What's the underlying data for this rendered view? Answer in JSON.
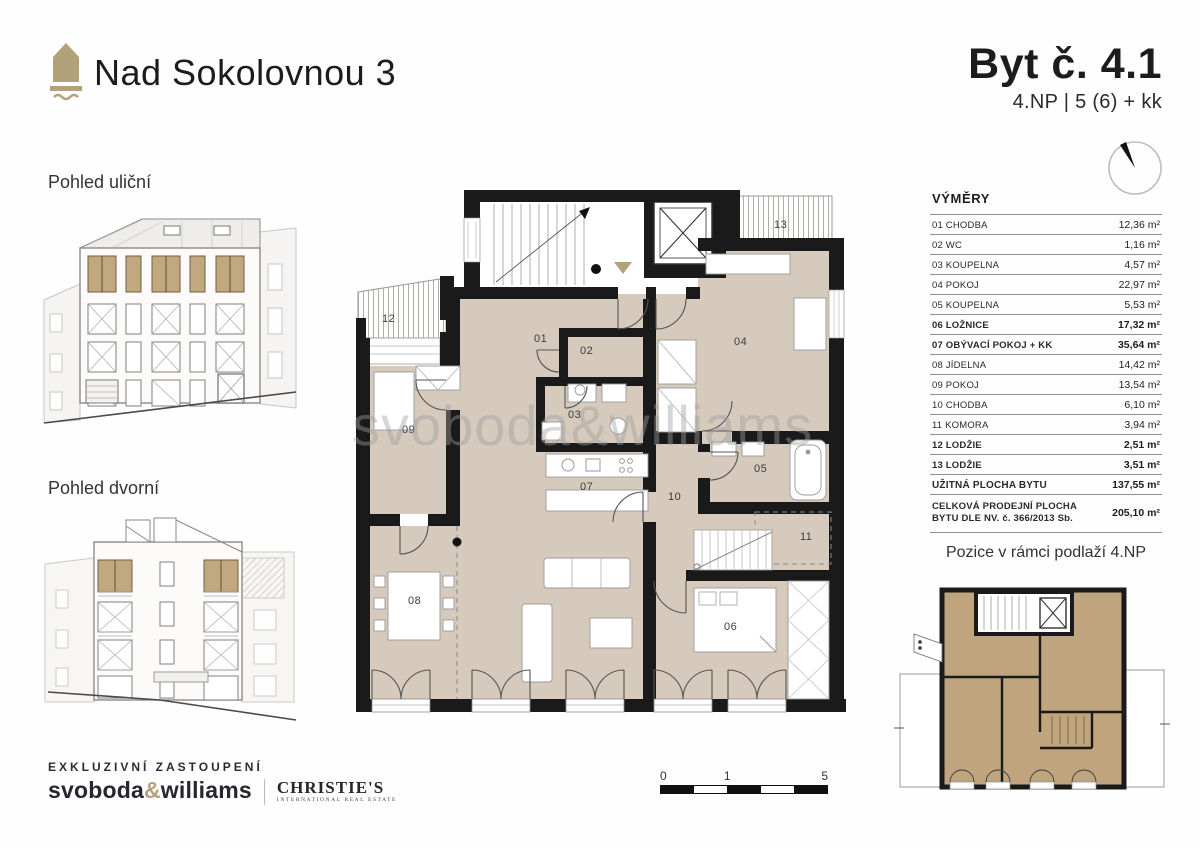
{
  "header": {
    "project": "Nad Sokolovnou 3",
    "unit": "Byt č. 4.1",
    "unit_spec": "4.NP | 5 (6) + kk"
  },
  "views": {
    "street": "Pohled uliční",
    "courtyard": "Pohled dvorní"
  },
  "areas_table": {
    "title": "VÝMĚRY",
    "rows": [
      {
        "label": "01 CHODBA",
        "value": "12,36 m²"
      },
      {
        "label": "02 WC",
        "value": "1,16 m²"
      },
      {
        "label": "03 KOUPELNA",
        "value": "4,57 m²"
      },
      {
        "label": "04 POKOJ",
        "value": "22,97 m²"
      },
      {
        "label": "05 KOUPELNA",
        "value": "5,53 m²"
      },
      {
        "label": "06 LOŽNICE",
        "value": "17,32 m²"
      },
      {
        "label": "07 OBÝVACÍ POKOJ + KK",
        "value": "35,64 m²"
      },
      {
        "label": "08 JÍDELNA",
        "value": "14,42 m²"
      },
      {
        "label": "09 POKOJ",
        "value": "13,54 m²"
      },
      {
        "label": "10 CHODBA",
        "value": "6,10 m²"
      },
      {
        "label": "11 KOMORA",
        "value": "3,94 m²"
      },
      {
        "label": "12 LODŽIE",
        "value": "2,51 m²"
      },
      {
        "label": "13 LODŽIE",
        "value": "3,51 m²"
      }
    ],
    "totals": [
      {
        "label": "UŽITNÁ PLOCHA BYTU",
        "value": "137,55 m²"
      },
      {
        "label": "CELKOVÁ PRODEJNÍ PLOCHA BYTU DLE NV. č. 366/2013 Sb.",
        "value": "205,10 m²"
      }
    ]
  },
  "position": {
    "caption": "Pozice v rámci podlaží 4.NP"
  },
  "plan_labels": {
    "r01": "01",
    "r02": "02",
    "r03": "03",
    "r04": "04",
    "r05": "05",
    "r06": "06",
    "r07": "07",
    "r08": "08",
    "r09": "09",
    "r10": "10",
    "r11": "11",
    "r12": "12",
    "r13": "13"
  },
  "scale_bar": {
    "t0": "0",
    "t1": "1",
    "t5": "5"
  },
  "footer": {
    "exclusive": "EXKLUZIVNÍ ZASTOUPENÍ",
    "brand_left": "svoboda",
    "brand_amp": "&",
    "brand_right": "williams",
    "partner": "CHRISTIE'S",
    "partner_sub": "INTERNATIONAL REAL ESTATE"
  },
  "watermark": "svoboda&williams",
  "colors": {
    "accent_tan": "#b3a179",
    "room_fill": "#d5cabc",
    "unit_highlight_fill": "#bfa47e",
    "wall": "#1a1a1a"
  }
}
